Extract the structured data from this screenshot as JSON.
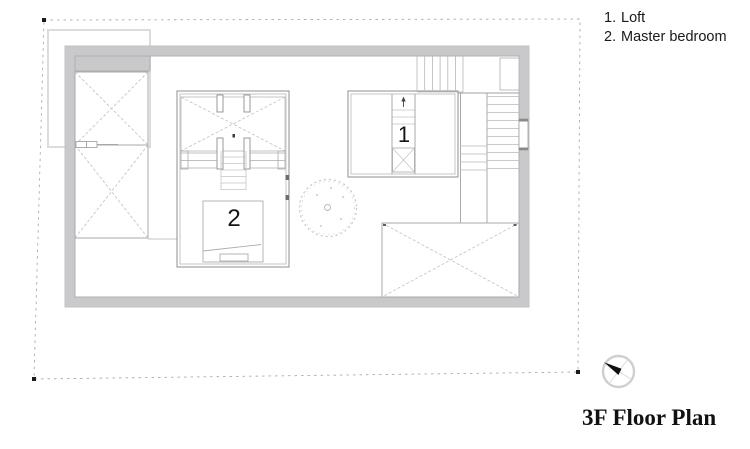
{
  "legend": {
    "items": [
      {
        "num": "1.",
        "label": "Loft"
      },
      {
        "num": "2.",
        "label": "Master bedroom"
      }
    ]
  },
  "plan": {
    "rooms": [
      {
        "number": "1",
        "name": "Loft"
      },
      {
        "number": "2",
        "name": "Master bedroom"
      }
    ]
  },
  "title": "3F Floor Plan",
  "icons": {
    "north_arrow_icon": "compass circle with black needle pointing north-west"
  },
  "colors": {
    "wall_fill": "#c9c9cb",
    "wall_line": "#a0a0a0",
    "light_line": "#c2c2c2",
    "dashed_boundary": "#a8a8a8",
    "text": "#1a1a1a"
  }
}
